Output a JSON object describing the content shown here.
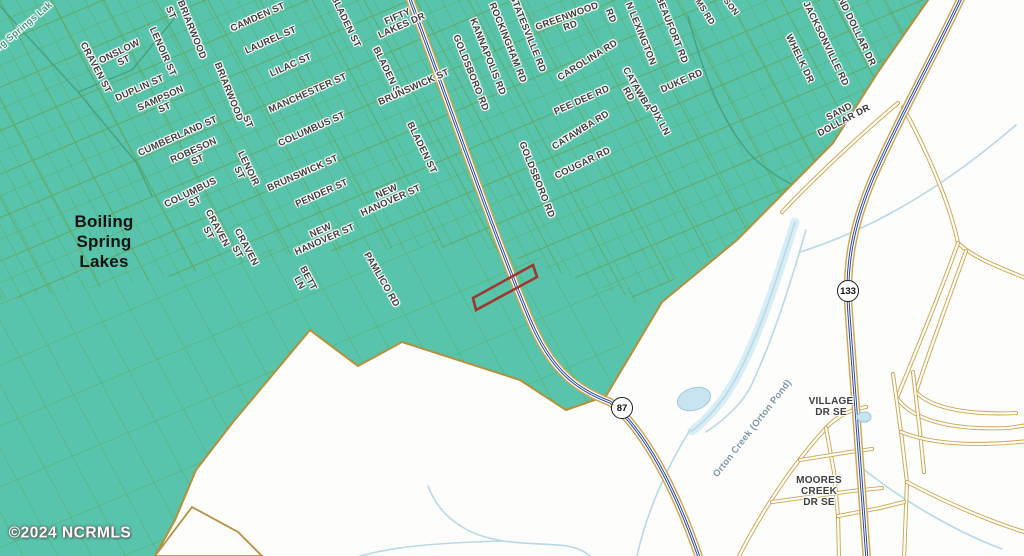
{
  "map": {
    "title": "Boiling Spring Lakes area parcel map",
    "watermark": "©2024 NCRMLS",
    "colors": {
      "background": "#fdfdfb",
      "land": "#57c4ab",
      "grid_line": "#5fa75f",
      "street_line": "#55a058",
      "boundary": "#b2923e",
      "road_casing": "#cfa64e",
      "road_fill": "#ffffff",
      "highway_blue": "#2b4a9e",
      "creek": "#b7d9e7",
      "creek_wash": "#d9edf5",
      "pond_fill": "#c8e4f0",
      "pond_edge": "#9cc6da",
      "stream_green": "#46a081",
      "parcel_highlight": "#9e372e",
      "label_gray": "#3e3e3e"
    },
    "shields": [
      {
        "num": "87",
        "x": 622,
        "y": 408
      },
      {
        "num": "133",
        "x": 848,
        "y": 291
      }
    ],
    "parcel_highlight": {
      "points": "473,298 533,265 537,277 476,310"
    },
    "vector": {
      "teal": "0,0 928,0 878,72 833,143 737,240 662,302 606,396 566,410 520,380 402,342 358,366 310,330 233,422 196,470 175,520 155,556 0,556",
      "boundary_path": "M928,0 L878,72 L833,143 L737,240 L662,302 L606,396 L566,410 L520,380 L402,342 L358,366 L310,330 L233,422 L196,470 L175,520 L155,556",
      "white_wedge": "155,556 192,507 238,532 262,556",
      "dense": "0,0 945,0 862,105 775,218 640,300 480,246 300,252 150,280 0,300",
      "sparse": "0,292 150,272 300,244 480,238 640,292 606,396 566,410 520,380 402,342 358,366 310,330 233,422 196,470 175,520 155,556 0,556",
      "patterns": [
        {
          "id": "gA",
          "sp": 15,
          "rot": 62,
          "sw": 0.9,
          "op": 0.85
        },
        {
          "id": "gB",
          "sp": 20,
          "rot": -23,
          "sw": 0.9,
          "op": 0.85
        },
        {
          "id": "gAt",
          "sp": 46,
          "rot": 62,
          "sw": 1.7,
          "op": 0.95
        },
        {
          "id": "gBt",
          "sp": 40,
          "rot": -23,
          "sw": 1.7,
          "op": 0.95
        },
        {
          "id": "gAs",
          "sp": 30,
          "rot": 62,
          "sw": 1.0,
          "op": 0.9
        },
        {
          "id": "gBs",
          "sp": 56,
          "rot": -23,
          "sw": 1.0,
          "op": 0.9
        }
      ],
      "grids": [
        {
          "poly": "dense",
          "pattern": "gA"
        },
        {
          "poly": "dense",
          "pattern": "gB"
        },
        {
          "poly": "dense",
          "pattern": "gAt"
        },
        {
          "poly": "dense",
          "pattern": "gBt"
        },
        {
          "poly": "sparse",
          "pattern": "gAs"
        },
        {
          "poly": "sparse",
          "pattern": "gBs"
        }
      ],
      "streams": [
        "M0,6 L78,92 L136,162 L152,196",
        "M78,92 L132,70 L178,14",
        "M688,16 C700,62 716,112 748,152 C766,172 792,186 814,194"
      ],
      "creek_wash": "M795,222 C780,268 762,330 736,378 C722,404 706,420 692,431",
      "creeks": [
        "M795,222 C780,268 762,330 736,378 C722,404 706,420 692,431",
        "M806,230 C792,278 774,338 750,388 C740,406 724,420 706,432",
        "M690,430 C664,472 646,514 636,560",
        "M428,486 C440,518 468,536 504,541 C545,547 572,540 590,556",
        "M348,560 C385,547 430,543 504,541",
        "M1016,125 C952,180 882,226 800,252",
        "M862,468 C902,500 952,530 1002,549"
      ],
      "minor_roads": [
        "M898,103 C868,128 820,172 782,212",
        "M903,107 C936,168 952,214 958,243 C972,257 998,267 1028,279",
        "M958,243 C938,300 912,360 897,398",
        "M897,398 C915,424 962,430 1008,428 L1028,425",
        "M966,251 C948,300 929,352 916,392",
        "M916,392 C933,410 974,415 1016,413",
        "M737,560 C765,505 795,462 826,428 C840,413 855,409 866,407",
        "M826,428 L834,472 L838,516 L839,560",
        "M800,460 L850,452 L872,449",
        "M772,502 L852,491 L882,488",
        "M893,374 L901,432 L907,482 L904,560",
        "M913,372 L920,432 L924,472",
        "M901,432 C936,446 982,446 1028,441",
        "M907,482 C952,506 1000,525 1028,533",
        "M838,516 L880,508 L904,502"
      ],
      "highways": [
        {
          "name": "NC-87",
          "d": "M408,-6 C448,100 492,230 530,320 C552,372 578,390 610,402 C645,430 676,490 700,560"
        },
        {
          "name": "NC-133",
          "d": "M963,-6 C938,48 898,120 872,180 C852,228 845,268 849,315 C853,380 860,470 867,560"
        }
      ],
      "ponds": [
        {
          "cx": 694,
          "cy": 399,
          "rx": 17,
          "ry": 11,
          "rot": -18
        },
        {
          "cx": 864,
          "cy": 417,
          "rx": 7,
          "ry": 5,
          "rot": 0
        }
      ]
    },
    "labels": [
      {
        "t": "Boiling Springs Lak",
        "x": 16,
        "y": 34,
        "r": -40,
        "cls": "lake"
      },
      {
        "t": "CRAVEN ST",
        "x": 95,
        "y": 68,
        "r": 62
      },
      {
        "t": "ONSLOW\nST",
        "x": 122,
        "y": 57,
        "r": -26
      },
      {
        "t": "LENOIR ST",
        "x": 162,
        "y": 52,
        "r": 66
      },
      {
        "t": "DUPLIN ST",
        "x": 140,
        "y": 89,
        "r": -24
      },
      {
        "t": "SAMPSON\nST",
        "x": 163,
        "y": 104,
        "r": -24
      },
      {
        "t": "ST",
        "x": 170,
        "y": 13,
        "r": 66
      },
      {
        "t": "BRIARWOOD",
        "x": 191,
        "y": 30,
        "r": 68
      },
      {
        "t": "BRIARWOOD",
        "x": 228,
        "y": 92,
        "r": 68
      },
      {
        "t": "ST",
        "x": 247,
        "y": 122,
        "r": 68
      },
      {
        "t": "CUMBERLAND ST",
        "x": 178,
        "y": 137,
        "r": -24
      },
      {
        "t": "ROBESON\nST",
        "x": 196,
        "y": 156,
        "r": -24
      },
      {
        "t": "COLUMBUS\nST",
        "x": 193,
        "y": 198,
        "r": -26
      },
      {
        "t": "CRAVEN\nST",
        "x": 212,
        "y": 231,
        "r": 62
      },
      {
        "t": "CRAVEN\nST",
        "x": 241,
        "y": 250,
        "r": 62
      },
      {
        "t": "LENOIR\nST",
        "x": 243,
        "y": 171,
        "r": 64
      },
      {
        "t": "CAMDEN ST",
        "x": 258,
        "y": 18,
        "r": -24
      },
      {
        "t": "LAUREL ST",
        "x": 271,
        "y": 41,
        "r": -24
      },
      {
        "t": "LILAC ST",
        "x": 291,
        "y": 66,
        "r": -24
      },
      {
        "t": "MANCHESTER ST",
        "x": 308,
        "y": 94,
        "r": -24
      },
      {
        "t": "COLUMBUS ST",
        "x": 312,
        "y": 130,
        "r": -24
      },
      {
        "t": "BRUNSWICK ST",
        "x": 303,
        "y": 174,
        "r": -24
      },
      {
        "t": "PENDER ST",
        "x": 322,
        "y": 194,
        "r": -24
      },
      {
        "t": "NEW\nHANOVER ST",
        "x": 323,
        "y": 236,
        "r": -24
      },
      {
        "t": "NEW\nHANOVER ST",
        "x": 389,
        "y": 197,
        "r": -24
      },
      {
        "t": "BETT\nLN",
        "x": 303,
        "y": 281,
        "r": 62
      },
      {
        "t": "PAMLICO RD",
        "x": 381,
        "y": 280,
        "r": 60
      },
      {
        "t": "BLADEN ST",
        "x": 345,
        "y": 22,
        "r": 64
      },
      {
        "t": "BLADEN ST",
        "x": 387,
        "y": 73,
        "r": 64
      },
      {
        "t": "BLADEN ST",
        "x": 421,
        "y": 148,
        "r": 64
      },
      {
        "t": "FIFTY\nLAKES DR",
        "x": 400,
        "y": 22,
        "r": -24
      },
      {
        "t": "BRUNSWICK ST",
        "x": 414,
        "y": 88,
        "r": -24
      },
      {
        "t": "GOLDSBORO RD",
        "x": 470,
        "y": 73,
        "r": 68
      },
      {
        "t": "KANNAPOLIS RD",
        "x": 487,
        "y": 57,
        "r": 68
      },
      {
        "t": "ROCKINGHAM RD",
        "x": 507,
        "y": 43,
        "r": 68
      },
      {
        "t": "STATESVILLE RD",
        "x": 527,
        "y": 34,
        "r": 68
      },
      {
        "t": "GREENWOOD\nRD",
        "x": 569,
        "y": 22,
        "r": -20
      },
      {
        "t": "CAROLINA RD",
        "x": 588,
        "y": 61,
        "r": -32
      },
      {
        "t": "PEE DEE RD",
        "x": 582,
        "y": 101,
        "r": -24
      },
      {
        "t": "CATAWBA RD",
        "x": 581,
        "y": 131,
        "r": -32
      },
      {
        "t": "GOLDSBORO RD",
        "x": 536,
        "y": 180,
        "r": 68
      },
      {
        "t": "COUGAR RD",
        "x": 583,
        "y": 164,
        "r": -26
      },
      {
        "t": "CATAWBA\nRD",
        "x": 632,
        "y": 92,
        "r": 60
      },
      {
        "t": "DUKE RD",
        "x": 682,
        "y": 82,
        "r": -24
      },
      {
        "t": "DIX LN",
        "x": 659,
        "y": 121,
        "r": 62
      },
      {
        "t": "BEAUFORT RD",
        "x": 671,
        "y": 30,
        "r": 68
      },
      {
        "t": "N LEXINGTON",
        "x": 640,
        "y": 34,
        "r": 68
      },
      {
        "t": "RD",
        "x": 610,
        "y": 16,
        "r": 68
      },
      {
        "t": "MS RD",
        "x": 705,
        "y": 12,
        "r": 58,
        "cls": "street-sm"
      },
      {
        "t": "SON",
        "x": 731,
        "y": 7,
        "r": 52,
        "cls": "street-sm"
      },
      {
        "t": "WHELK DR",
        "x": 799,
        "y": 59,
        "r": 64
      },
      {
        "t": "JACKSONVILLE RD",
        "x": 825,
        "y": 44,
        "r": 64
      },
      {
        "t": "SAND DOLLAR DR",
        "x": 853,
        "y": 26,
        "r": 64
      },
      {
        "t": "SAND\nDOLLAR DR",
        "x": 842,
        "y": 117,
        "r": -28
      },
      {
        "t": "VILLAGE\nDR SE",
        "x": 831,
        "y": 408,
        "r": 0,
        "cls": "place"
      },
      {
        "t": "MOORES\nCREEK\nDR SE",
        "x": 819,
        "y": 492,
        "r": 0,
        "cls": "place"
      },
      {
        "t": "Orton Creek (Orton Pond)",
        "x": 753,
        "y": 429,
        "r": -52,
        "cls": "water"
      },
      {
        "t": "Boiling\nSpring\nLakes",
        "x": 104,
        "y": 242,
        "r": 0,
        "cls": "area"
      }
    ]
  }
}
